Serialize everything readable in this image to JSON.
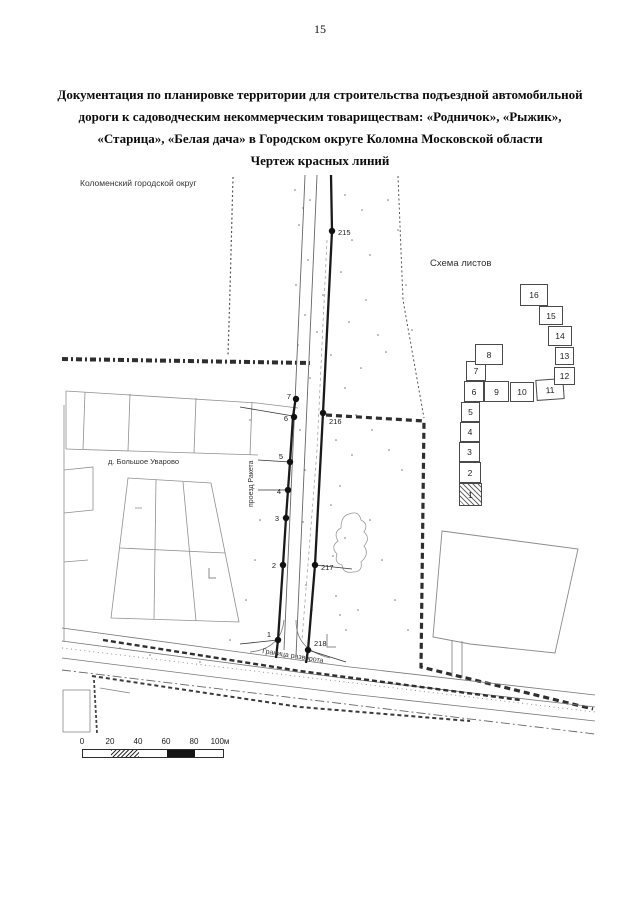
{
  "page_number": "15",
  "title": {
    "lines": [
      "Документация по планировке территории для строительства подъездной автомобильной",
      "дороги к садоводческим некоммерческим товариществам: «Родничок», «Рыжик»,",
      "«Старица», «Белая дача» в Городском округе Коломна Московской области",
      "Чертеж красных линий"
    ]
  },
  "map": {
    "region_label": "Коломенский городской округ",
    "village_label": "д. Большое Уварово",
    "street_label": "проезд Ракета",
    "boundary_label": "Граница разворота",
    "points_left": [
      "7",
      "6",
      "5",
      "4",
      "3",
      "2",
      "1"
    ],
    "points_right": [
      "215",
      "216",
      "217",
      "218"
    ]
  },
  "sheet_scheme": {
    "title": "Схема листов",
    "sheets": [
      "1",
      "2",
      "3",
      "4",
      "5",
      "6",
      "7",
      "8",
      "9",
      "10",
      "11",
      "12",
      "13",
      "14",
      "15",
      "16"
    ],
    "current_sheet": "1"
  },
  "scale_bar": {
    "ticks": [
      "0",
      "20",
      "40",
      "60",
      "80",
      "100м"
    ]
  }
}
